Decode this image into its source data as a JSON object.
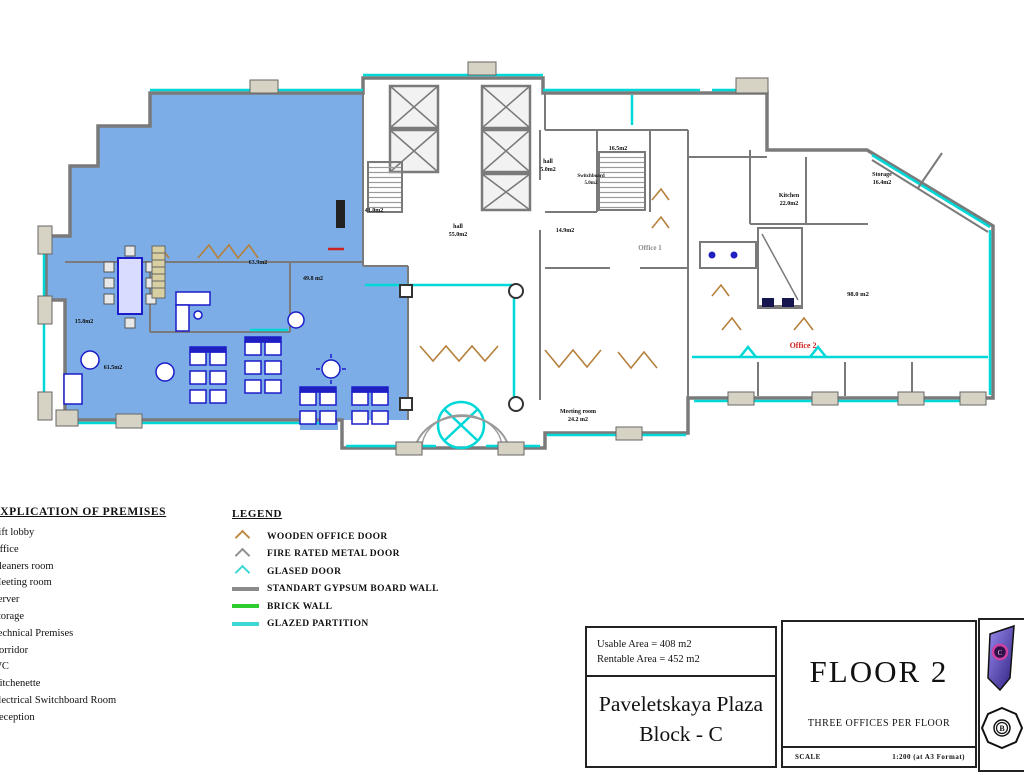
{
  "plan": {
    "colors": {
      "office_fill": "#7cade6",
      "glazing": "#00d8d8",
      "wall": "#7a7a7a",
      "furniture": "#1c1cc8",
      "door": "#b5803c",
      "highlight_label": "#cc2222"
    },
    "labels": [
      {
        "text": "Office 1",
        "x": 650,
        "y": 250,
        "size": 7,
        "color": "#8a8a8a"
      },
      {
        "text": "Office 2",
        "x": 803,
        "y": 348,
        "size": 8,
        "color": "#cc2222"
      },
      {
        "text": "hall",
        "x": 458,
        "y": 228,
        "size": 6,
        "color": "#101010"
      },
      {
        "text": "55.0m2",
        "x": 458,
        "y": 236,
        "size": 6,
        "color": "#101010"
      },
      {
        "text": "41.0m2",
        "x": 374,
        "y": 212,
        "size": 6,
        "color": "#101010"
      },
      {
        "text": "hall",
        "x": 548,
        "y": 163,
        "size": 6,
        "color": "#101010"
      },
      {
        "text": "5.0m2",
        "x": 548,
        "y": 171,
        "size": 6,
        "color": "#101010"
      },
      {
        "text": "16.5m2",
        "x": 618,
        "y": 150,
        "size": 6,
        "color": "#101010"
      },
      {
        "text": "Switchboard",
        "x": 591,
        "y": 177,
        "size": 5,
        "color": "#101010"
      },
      {
        "text": "5.0m2",
        "x": 591,
        "y": 184,
        "size": 5,
        "color": "#101010"
      },
      {
        "text": "14.9m2",
        "x": 565,
        "y": 232,
        "size": 6,
        "color": "#101010"
      },
      {
        "text": "Kitchen",
        "x": 789,
        "y": 197,
        "size": 6,
        "color": "#101010"
      },
      {
        "text": "22.0m2",
        "x": 789,
        "y": 205,
        "size": 6,
        "color": "#101010"
      },
      {
        "text": "Storage",
        "x": 882,
        "y": 176,
        "size": 6,
        "color": "#101010"
      },
      {
        "text": "16.4m2",
        "x": 882,
        "y": 184,
        "size": 6,
        "color": "#101010"
      },
      {
        "text": "Meeting room",
        "x": 578,
        "y": 413,
        "size": 6,
        "color": "#101010"
      },
      {
        "text": "24.2 m2",
        "x": 578,
        "y": 421,
        "size": 6,
        "color": "#101010"
      },
      {
        "text": "98.0 m2",
        "x": 858,
        "y": 296,
        "size": 6.5,
        "color": "#101010"
      },
      {
        "text": "63.9m2",
        "x": 258,
        "y": 264,
        "size": 6,
        "color": "#101010"
      },
      {
        "text": "61.5m2",
        "x": 113,
        "y": 369,
        "size": 6,
        "color": "#101010"
      },
      {
        "text": "15.8m2",
        "x": 84,
        "y": 323,
        "size": 6,
        "color": "#101010"
      },
      {
        "text": "49.8 m2",
        "x": 313,
        "y": 280,
        "size": 6,
        "color": "#101010"
      }
    ]
  },
  "explication": {
    "title": "EXPLICATION OF PREMISES",
    "items": [
      "Lift lobby",
      "Office",
      "Cleaners room",
      "Meeting room",
      "Server",
      "Storage",
      "Technical Premises",
      "Corridor",
      "WC",
      "Kitchenette",
      "Electrical Switchboard Room",
      "Reception"
    ]
  },
  "legend": {
    "title": "LEGEND",
    "items": [
      {
        "kind": "door",
        "color": "#c08a45",
        "label": "WOODEN OFFICE DOOR"
      },
      {
        "kind": "door",
        "color": "#909090",
        "label": "FIRE RATED METAL DOOR"
      },
      {
        "kind": "door",
        "color": "#3fd6d6",
        "label": "GLASED DOOR"
      },
      {
        "kind": "wall",
        "color": "#8a8a8a",
        "label": "STANDART GYPSUM BOARD WALL"
      },
      {
        "kind": "wall",
        "color": "#2ecc2e",
        "label": "BRICK WALL"
      },
      {
        "kind": "wall",
        "color": "#3fd6d6",
        "label": "GLAZED PARTITION"
      }
    ]
  },
  "title_block": {
    "usable_area": "Usable Area = 408 m2",
    "rentable_area": "Rentable Area = 452 m2",
    "project": "Paveletskaya Plaza",
    "block": "Block - C",
    "floor": "FLOOR 2",
    "subtitle": "THREE  OFFICES PER FLOOR",
    "scale_label": "SCALE",
    "scale_value": "1:200 (at A3 Format)",
    "key_map": {
      "block_c": "C",
      "block_b": "B"
    }
  }
}
